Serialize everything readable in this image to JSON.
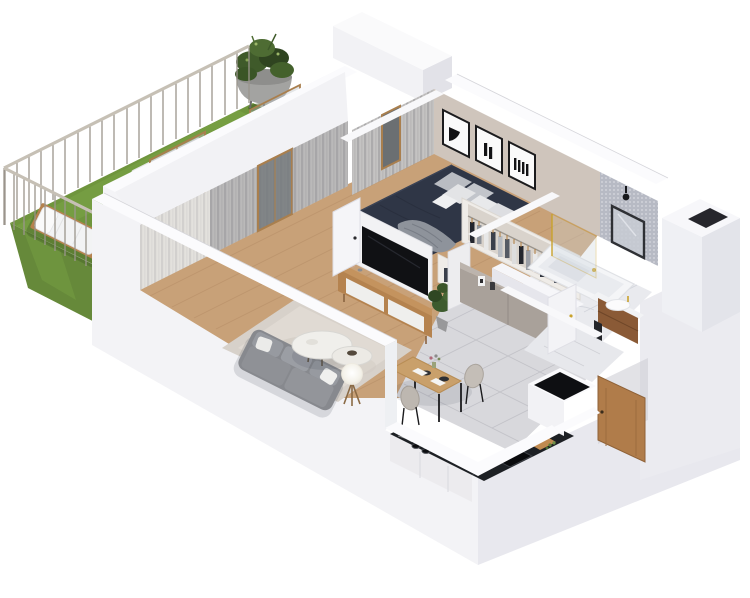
{
  "scene": {
    "type": "isometric-3d-floor-plan-render",
    "rooms": [
      "balcony",
      "living-room",
      "bedroom",
      "bathroom",
      "kitchen-dining",
      "entry"
    ]
  },
  "colors": {
    "background": "#ffffff",
    "wall_white": "#f3f3f6",
    "wall_top": "#fbfbfd",
    "wall_shade": "#e8e8ee",
    "wall_dark": "#dfe0e7",
    "grass": "#6f953d",
    "grass_dark": "#4c6a26",
    "wood_floor": "#c8a178",
    "wood_furniture": "#b5834f",
    "rug": "#d7d1ca",
    "sofa": "#87898e",
    "bed": "#2f3646",
    "accent_wall": "#cfc5bc",
    "mosaic_wall": "#b7bac4",
    "marble_floor": "#e9eaee",
    "tile_floor": "#d8d8dc",
    "counter": "#1d2024",
    "cabinet": "#a9a19a",
    "curtain_sheer": "#e7e5e1",
    "curtain_gray": "#96969a",
    "tv": "#101114",
    "railing": "#c6c0b5",
    "brass": "#c9a22c",
    "door_wood": "#b07c4a"
  }
}
